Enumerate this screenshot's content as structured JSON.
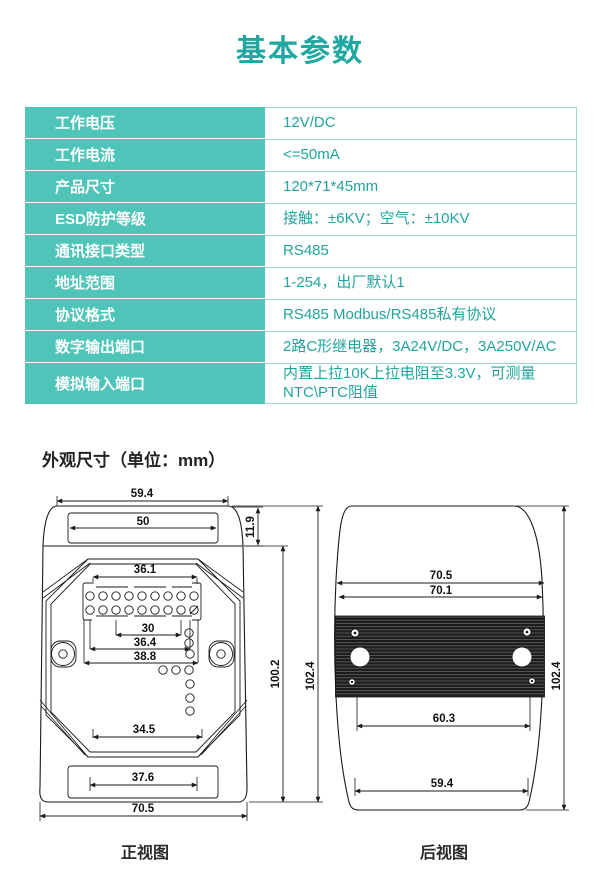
{
  "title": "基本参数",
  "colors": {
    "accent_teal": "#1fa8a1",
    "table_cell_teal": "#4fc5b9",
    "table_border_teal": "#9ad8d2",
    "drawing_line": "#1a1a1a"
  },
  "spec_table": {
    "rows": [
      {
        "label": "工作电压",
        "value": "12V/DC"
      },
      {
        "label": "工作电流",
        "value": "<=50mA"
      },
      {
        "label": "产品尺寸",
        "value": "120*71*45mm"
      },
      {
        "label": "ESD防护等级",
        "value": "接触：±6KV；空气：±10KV"
      },
      {
        "label": "通讯接口类型",
        "value": "RS485"
      },
      {
        "label": "地址范围",
        "value": "1-254，出厂默认1"
      },
      {
        "label": "协议格式",
        "value": "RS485 Modbus/RS485私有协议"
      },
      {
        "label": "数字输出端口",
        "value": "2路C形继电器，3A24V/DC，3A250V/AC"
      },
      {
        "label": "模拟输入端口",
        "value": "内置上拉10K上拉电阻至3.3V，可测量NTC\\PTC阻值"
      }
    ]
  },
  "drawings": {
    "section_title": "外观尺寸（单位：mm）",
    "front_view": {
      "caption": "正视图",
      "dims": {
        "top_width": "59.4",
        "top_recess_width": "50",
        "top_cap_height": "11.9",
        "terminal_width": "36.1",
        "pin_row_width": "30",
        "inner_width_1": "36.4",
        "inner_width_2": "38.8",
        "lower_inner_width": "34.5",
        "bottom_recess_width": "37.6",
        "bottom_width": "70.5",
        "body_height": "100.2",
        "total_height": "102.4"
      }
    },
    "back_view": {
      "caption": "后视图",
      "dims": {
        "upper_width_outer": "70.5",
        "upper_width_inner": "70.1",
        "rail_width": "60.3",
        "bottom_width": "59.4",
        "total_height": "102.4"
      }
    }
  }
}
